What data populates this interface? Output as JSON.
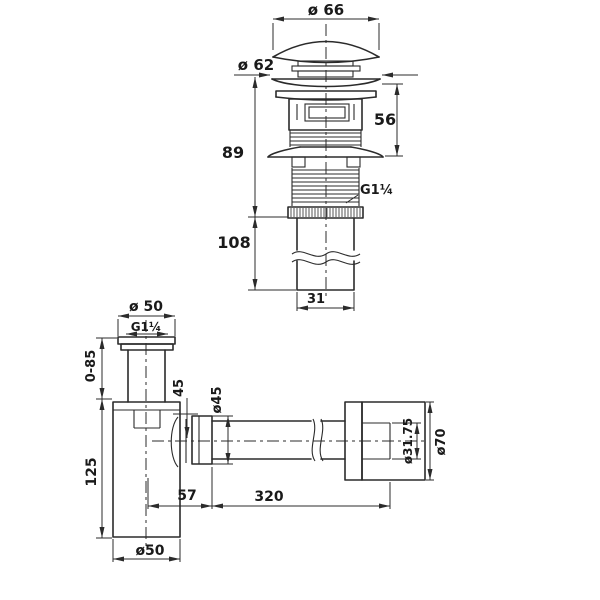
{
  "drawing": {
    "background": "#ffffff",
    "line_color": "#2b2b2b",
    "description": "Dimensional technical drawing of a pop-up basin waste drain (top) and a bottle trap with wall outlet pipe (bottom)"
  },
  "labels": {
    "drain_cap_dia": "ø 66",
    "drain_flange_dia": "ø 62",
    "drain_upper_height": "56",
    "drain_height": "89",
    "drain_thread": "G1¼",
    "drain_tail_length": "108",
    "drain_tail_width": "31",
    "trap_inlet_dia": "ø 50",
    "trap_inlet_thread": "G1¼",
    "trap_adjust": "0-85",
    "trap_inlet_drop": "45",
    "trap_nut_dia": "ø45",
    "trap_body_height": "125",
    "trap_body_dia": "ø50",
    "trap_outlet_offset": "57",
    "trap_outlet_length": "320",
    "trap_outlet_pipe_dia": "ø31.75",
    "trap_wall_flange_dia": "ø70"
  }
}
